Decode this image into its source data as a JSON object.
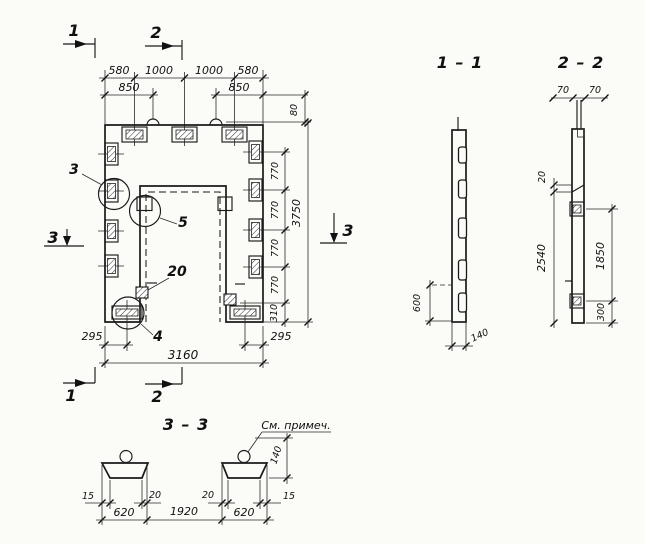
{
  "plan": {
    "marks": {
      "top_1": "1",
      "top_2": "2",
      "bottom_1": "1",
      "bottom_2": "2",
      "left_3": "3",
      "right_3": "3"
    },
    "dims": {
      "row1": [
        "580",
        "1000",
        "1000",
        "580"
      ],
      "row2": [
        "850",
        "850"
      ],
      "loop_height": "80",
      "right_segments": [
        "770",
        "770",
        "770",
        "770",
        "310"
      ],
      "overall_height": "3750",
      "bottom_left": "295",
      "bottom_right": "295",
      "overall_width": "3160"
    },
    "callouts": {
      "c3": "3",
      "c5": "5",
      "c20": "20",
      "c4": "4"
    }
  },
  "section_1_1": {
    "title": "1 – 1",
    "dim_edge": "600",
    "dim_thickness": "140"
  },
  "section_2_2": {
    "title": "2 – 2",
    "dim_70a": "70",
    "dim_70b": "70",
    "dim_step": "20",
    "dim_height": "2540",
    "dim_embeds": "1850",
    "dim_bottom": "300"
  },
  "section_3_3": {
    "title": "3 – 3",
    "note": "См. примеч.",
    "dim_rib_height": "140",
    "offsets": [
      "15",
      "20",
      "20",
      "15"
    ],
    "bottom": [
      "620",
      "1920",
      "620"
    ]
  }
}
